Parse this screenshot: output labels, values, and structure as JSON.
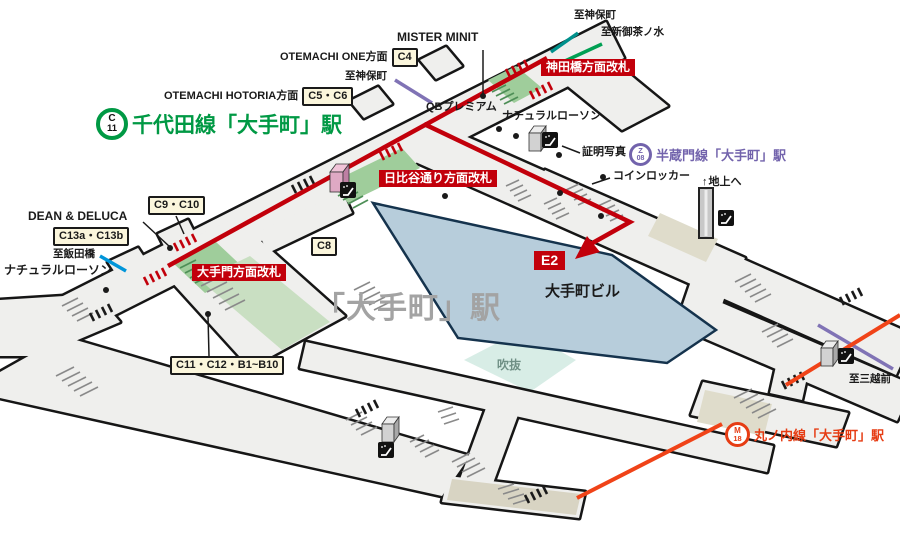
{
  "station": {
    "big_label": "「大手町」駅",
    "building": "大手町ビル",
    "atrium": "吹抜",
    "exit_e2": "E2"
  },
  "lines": {
    "chiyoda": {
      "code": "C",
      "num": "11",
      "title": "千代田線「大手町」駅",
      "color": "#009944"
    },
    "hanzomon": {
      "code": "Z",
      "num": "08",
      "title": "半蔵門線「大手町」駅",
      "color": "#7263AC"
    },
    "marunouchi": {
      "code": "M",
      "num": "18",
      "title": "丸ノ内線「大手町」駅",
      "color": "#E63C13"
    }
  },
  "gates": {
    "kandabashi": "神田橋方面改札",
    "hibiya": "日比谷通り方面改札",
    "otemon": "大手門方面改札"
  },
  "exits": {
    "c4": "C4",
    "c5_c6": "C5・C6",
    "c8": "C8",
    "c9_c10": "C9・C10",
    "c13": "C13a・C13b",
    "c11_c12": "C11・C12・B1~B10"
  },
  "directions": {
    "otemachi_one": "OTEMACHI ONE方面",
    "otemachi_hotoria": "OTEMACHI HOTORIA方面",
    "jimbocho_west": "至神保町",
    "jimbocho_north": "至神保町",
    "shin_ochanomizu": "至新御茶ノ水",
    "iidabashi": "至飯田橋",
    "mitsukoshimae": "至三越前",
    "ground": "地上へ",
    "ground_arrow": "↑"
  },
  "shops": {
    "mister_minit": "MISTER MINIT",
    "qb_premium": "QBプレミアム",
    "lawson_top": "ナチュラルローソン",
    "lawson_left": "ナチュラルローソン",
    "dean_deluca": "DEAN & DELUCA",
    "photo_booth": "証明写真",
    "coin_locker": "コインロッカー"
  },
  "colors": {
    "route_red": "#C2000B",
    "chiyoda_green": "#009944",
    "hanzomon_purple": "#7263AC",
    "marunouchi_orange": "#E63C13",
    "tozai_blue": "#0095D9",
    "mita_teal": "#00918C",
    "building_blue": "#B7CDDB",
    "atrium_teal": "#D8EDE6",
    "corridor_gray": "#EFEFED"
  }
}
